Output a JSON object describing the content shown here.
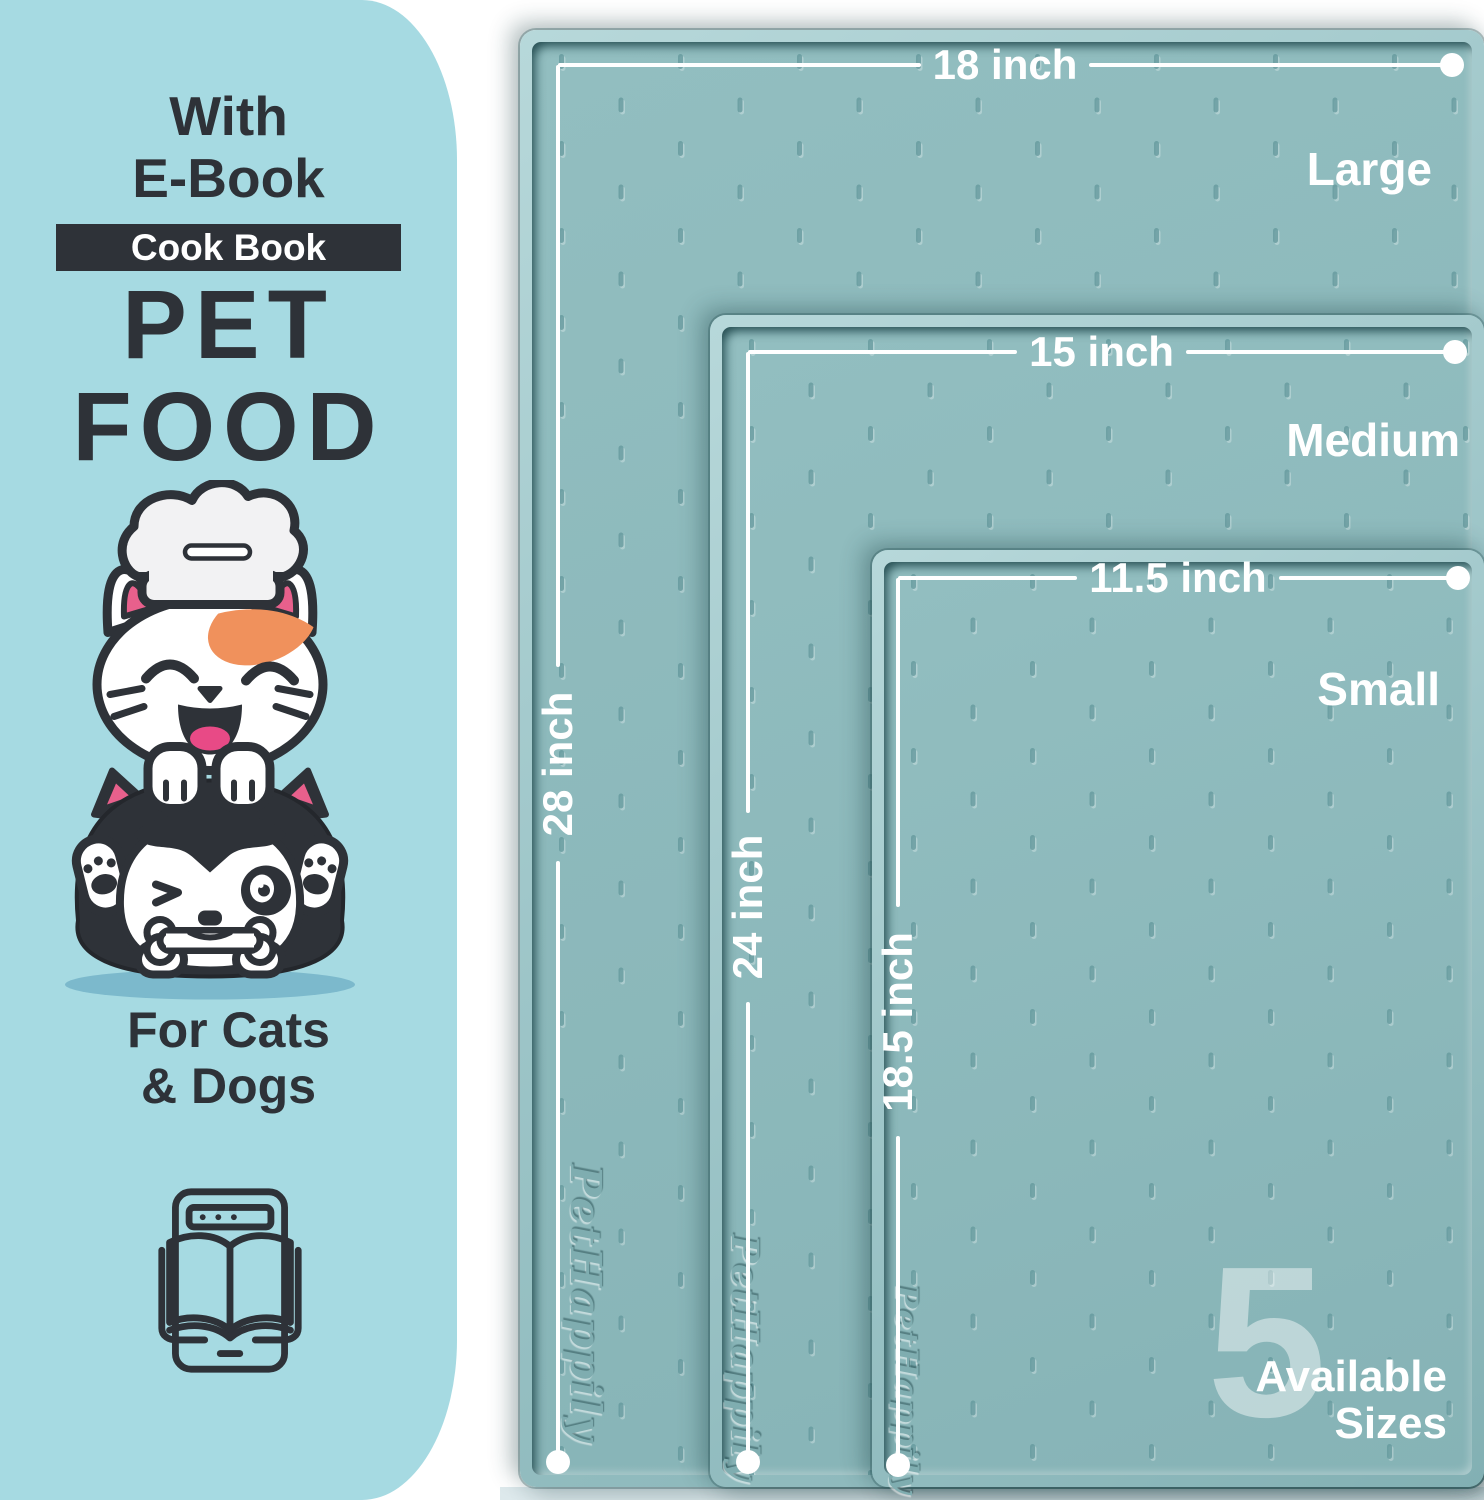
{
  "left_panel": {
    "top_line1": "With",
    "top_line2": "E-Book",
    "badge_label": "Cook Book",
    "title_line1": "PET",
    "title_line2": "FOOD",
    "bottom_line1": "For Cats",
    "bottom_line2": "& Dogs"
  },
  "mats": [
    {
      "size_label": "Large",
      "width_label": "18 inch",
      "length_label": "28 inch"
    },
    {
      "size_label": "Medium",
      "width_label": "15 inch",
      "length_label": "24 inch"
    },
    {
      "size_label": "Small",
      "width_label": "11.5 inch",
      "length_label": "18.5 inch"
    }
  ],
  "sizes_badge": {
    "number": "5",
    "line1": "Available",
    "line2": "Sizes"
  },
  "brand_embossed": "PetHappily",
  "icons": {
    "illustration": "cat-dog-chef-illustration",
    "ebook": "ebook-tablet-icon"
  },
  "colors": {
    "panel_blue": "#a6dae2",
    "ink": "#2e3238",
    "mat_surface": "#8cb9bb",
    "mat_rim": "#9dc5c8",
    "accent_pink": "#e8608c",
    "accent_orange": "#f0915c",
    "white": "#ffffff"
  }
}
